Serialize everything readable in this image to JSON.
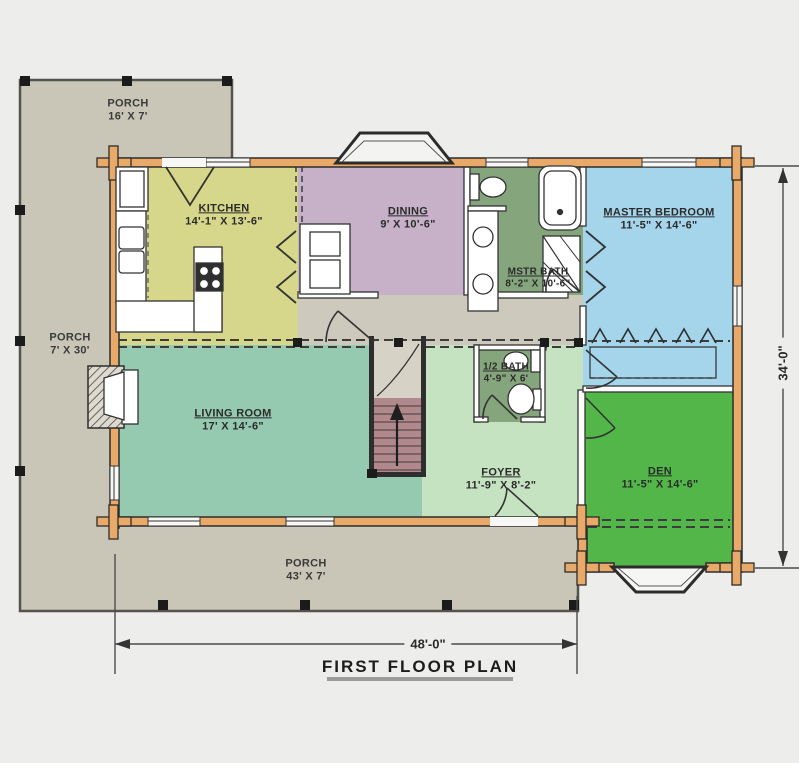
{
  "title": "FIRST FLOOR PLAN",
  "dimensions": {
    "overall_width": "48'-0\"",
    "overall_height": "34'-0\""
  },
  "rooms": {
    "porch_top": {
      "name": "PORCH",
      "size": "16' X 7'"
    },
    "porch_left": {
      "name": "PORCH",
      "size": "7' X 30'"
    },
    "porch_bottom": {
      "name": "PORCH",
      "size": "43' X 7'"
    },
    "kitchen": {
      "name": "KITCHEN",
      "size": "14'-1\" X 13'-6\""
    },
    "dining": {
      "name": "DINING",
      "size": "9' X 10'-6\""
    },
    "mstr_bath": {
      "name": "MSTR BATH",
      "size": "8'-2\" X 10'-6\""
    },
    "master_bedroom": {
      "name": "MASTER BEDROOM",
      "size": "11'-5\" X 14'-6\""
    },
    "living_room": {
      "name": "LIVING ROOM",
      "size": "17' X 14'-6\""
    },
    "half_bath": {
      "name": "1/2 BATH",
      "size": "4'-9\" X 6'"
    },
    "foyer": {
      "name": "FOYER",
      "size": "11'-9\" X 8'-2\""
    },
    "den": {
      "name": "DEN",
      "size": "11'-5\" X 14'-6\""
    }
  },
  "colors": {
    "background": "#edeeec",
    "porch": "#c9c6b8",
    "hall": "#cdc9bc",
    "kitchen": "#d7d78c",
    "dining": "#c6b1c8",
    "bath_green": "#85a67c",
    "master_bedroom": "#a5d5ea",
    "living_room": "#95cab1",
    "foyer": "#c6e3c1",
    "den": "#52b748",
    "stairs": "#b1898d",
    "log_wall": "#e9a969",
    "landing": "#d6d2c5"
  }
}
